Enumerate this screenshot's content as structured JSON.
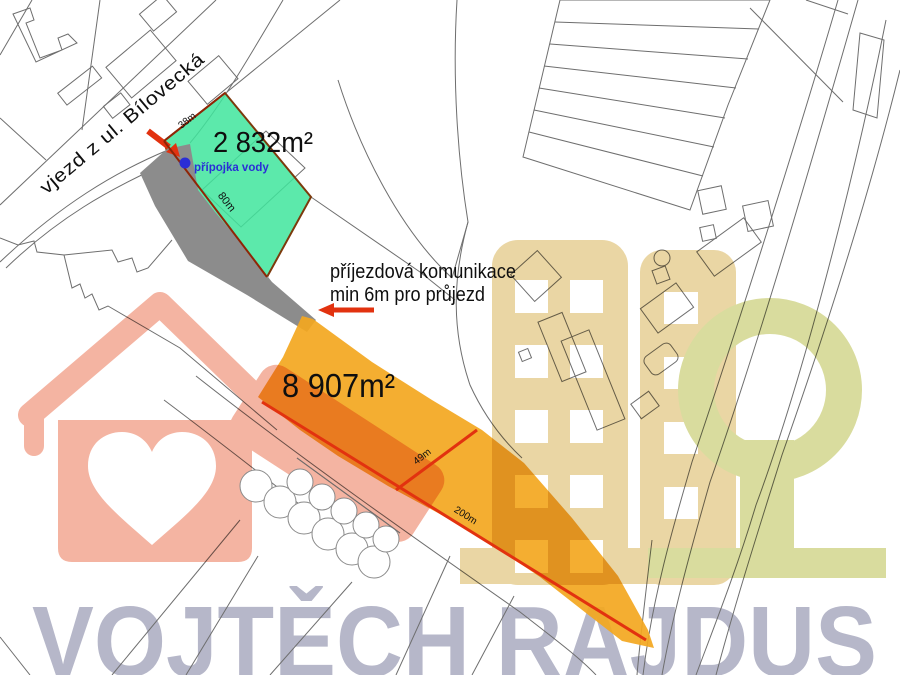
{
  "map": {
    "street_label": "vjezd z ul. Bílovecká",
    "access_note_line1": "příjezdová komunikace",
    "access_note_line2": "min 6m pro průjezd",
    "parcels": {
      "green": {
        "area_label": "2 832m²",
        "dim_width": "38m",
        "dim_length": "80m",
        "utility_label": "přípojka vody"
      },
      "orange": {
        "area_label": "8 907m²",
        "dim_width": "49m",
        "dim_length": "200m"
      }
    }
  },
  "watermark": {
    "agent_name": "VOJTĚCH RAJDUS"
  },
  "colors": {
    "map_line": "#6E6E6E",
    "parcel_green": "#3FE59C",
    "parcel_green_border": "#7C3A0C",
    "driveway_gray": "#8C8C8C",
    "parcel_orange": "#F3A71F",
    "dim_red_dark": "#8F2506",
    "annotation_red": "#E2320F",
    "utility_blue": "#2A2ED6",
    "label_black": "#0F0F0F",
    "wm_text": "#B6B7C9",
    "wm_salmon": "#F4B4A2",
    "wm_tan": "#EAD6A4",
    "wm_olive": "#D9DC9E",
    "cloud_stroke": "#8A8A8A",
    "cloud_fill": "#FFFFFF"
  }
}
